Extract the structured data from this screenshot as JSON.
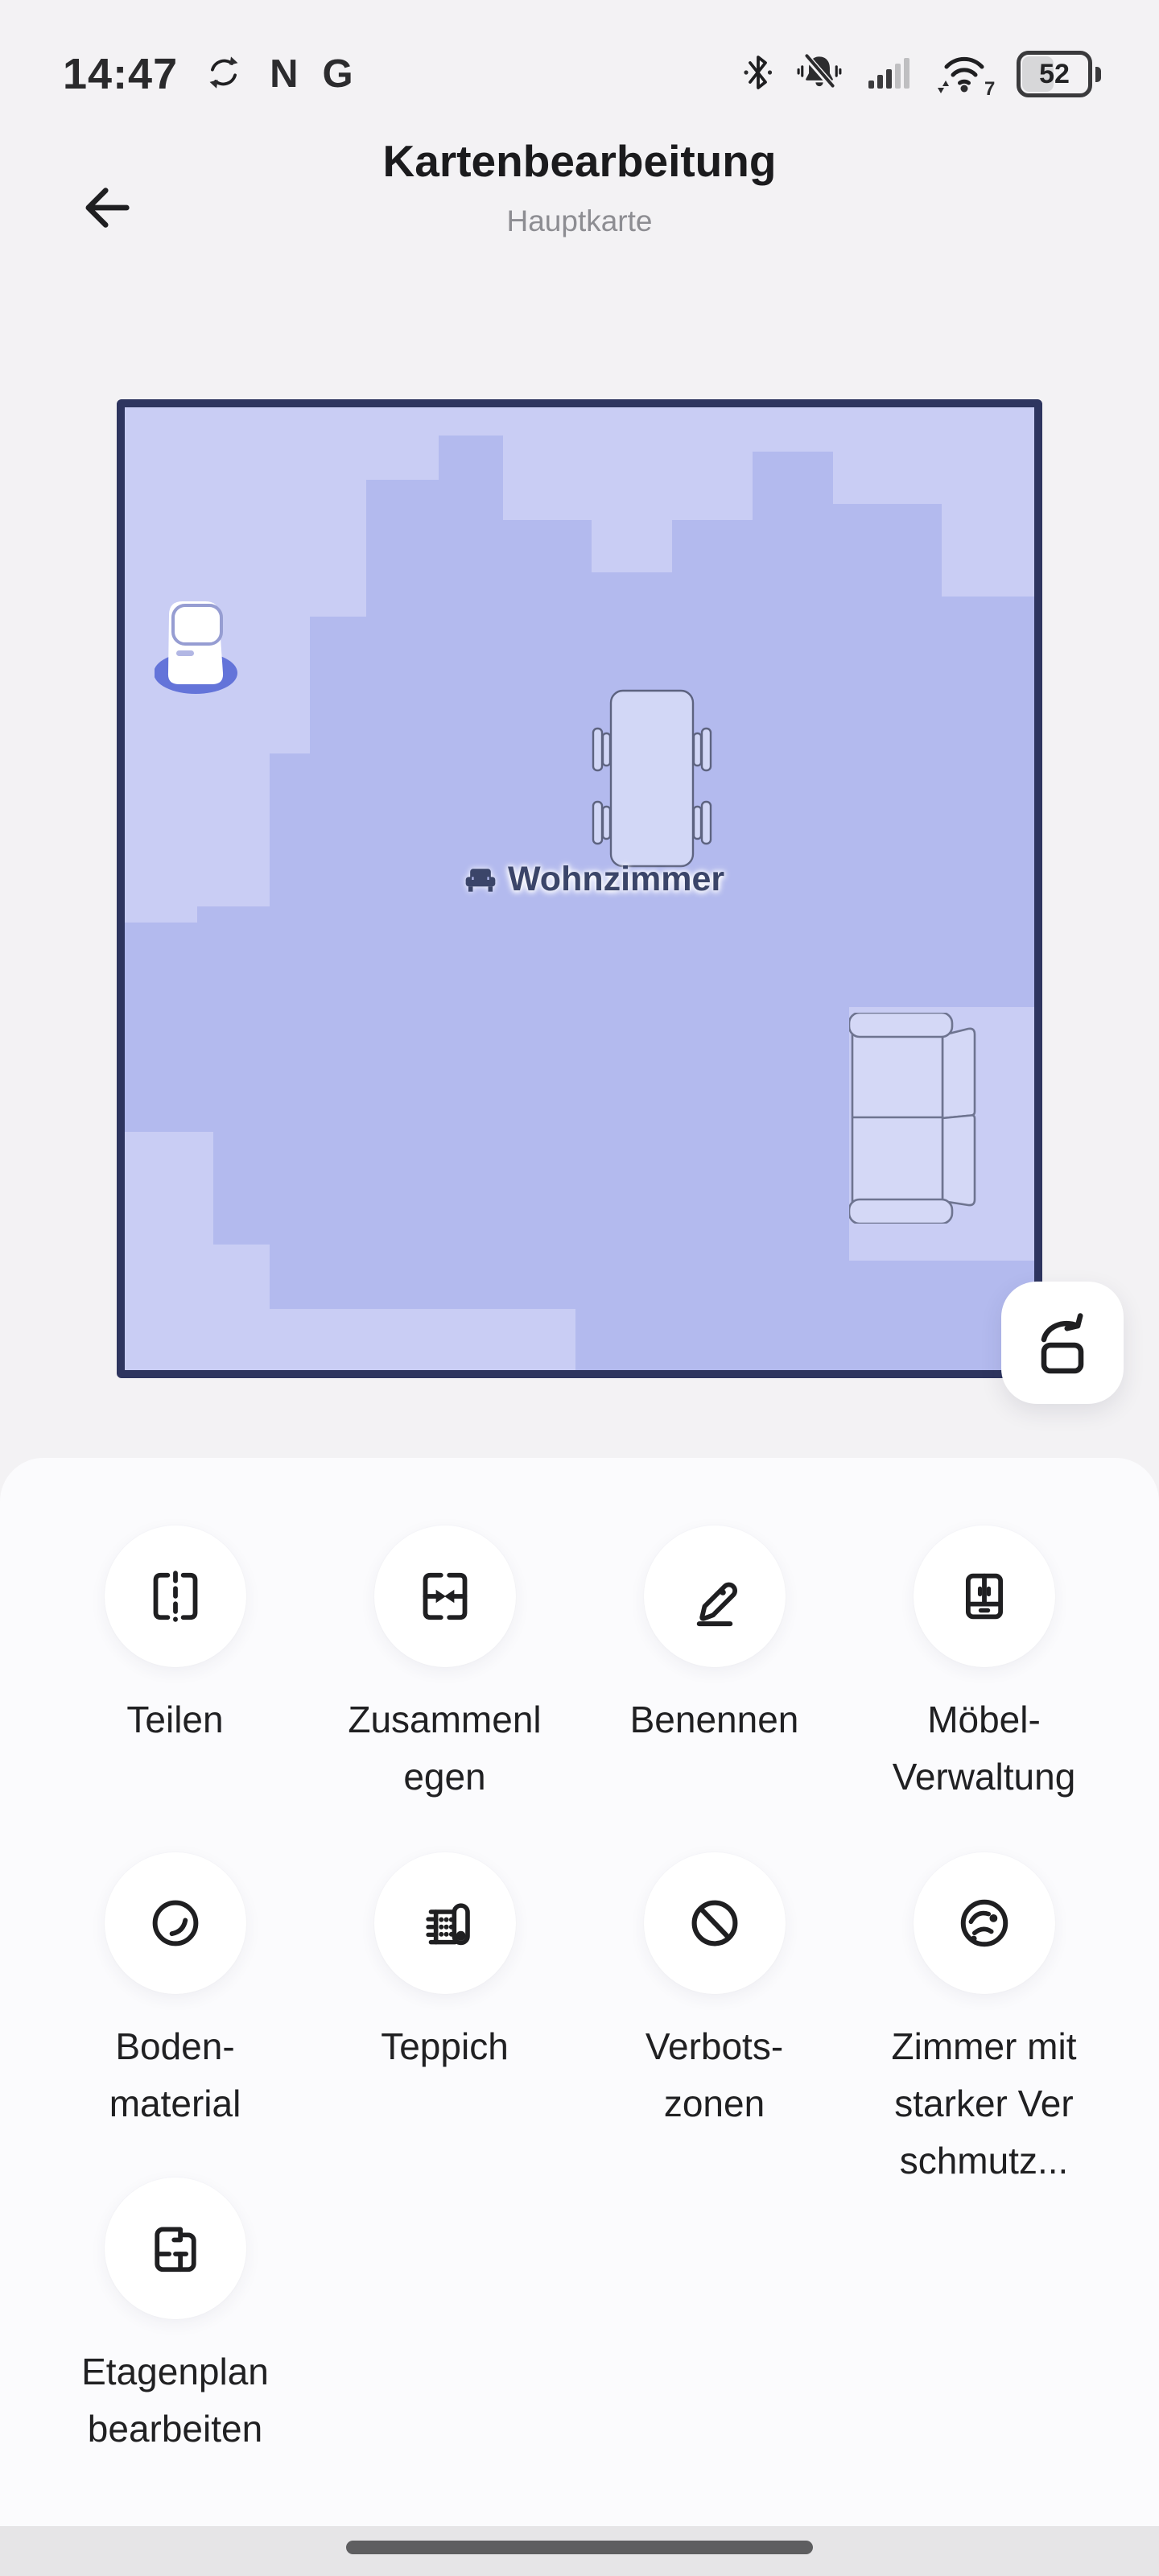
{
  "status_bar": {
    "time": "14:47",
    "notification_letters": [
      "N",
      "G"
    ],
    "wifi_generation": "7",
    "battery_percent": "52"
  },
  "header": {
    "title": "Kartenbearbeitung",
    "subtitle": "Hauptkarte"
  },
  "map": {
    "room_label": "Wohnzimmer",
    "colors": {
      "border": "#2e355f",
      "floor_main": "#b3baee",
      "floor_light": "#c9cdf4",
      "dock_ring": "#6474d9",
      "furniture_fill": "#d2d7f6",
      "room_label_text": "#3b4569"
    }
  },
  "actions": [
    {
      "id": "split",
      "label": "Teilen"
    },
    {
      "id": "merge",
      "label": "Zusammenl\negen"
    },
    {
      "id": "rename",
      "label": "Benennen"
    },
    {
      "id": "furniture-management",
      "label": "Möbel-\nVerwaltung"
    },
    {
      "id": "floor-material",
      "label": "Boden-\nmaterial"
    },
    {
      "id": "carpet",
      "label": "Teppich"
    },
    {
      "id": "no-go-zones",
      "label": "Verbots-\nzonen"
    },
    {
      "id": "heavily-dirty-room",
      "label": "Zimmer mit\nstarker Ver\nschmutz..."
    },
    {
      "id": "edit-floorplan",
      "label": "Etagenplan\nbearbeiten"
    }
  ]
}
